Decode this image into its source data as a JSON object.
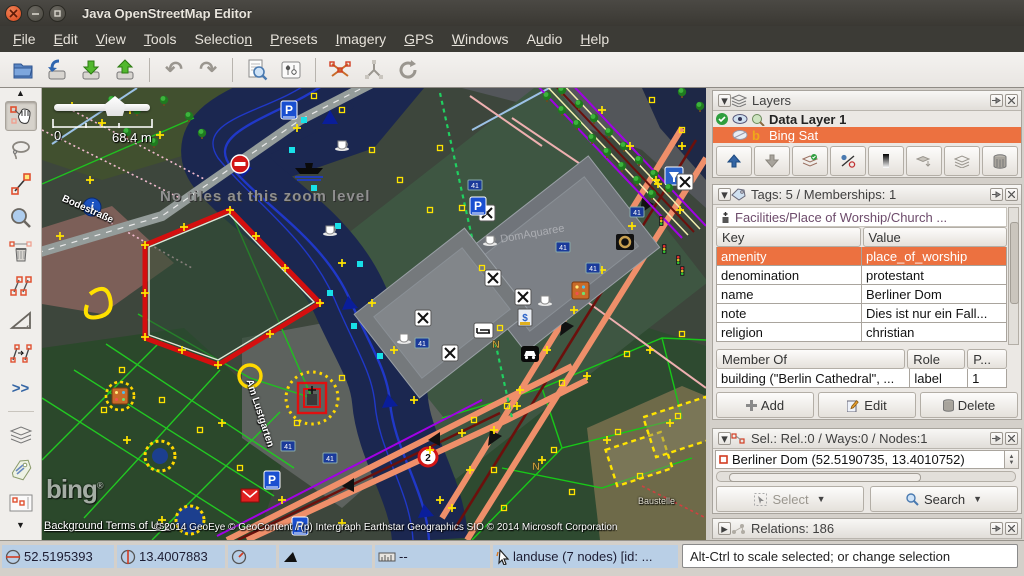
{
  "window": {
    "title": "Java OpenStreetMap Editor"
  },
  "menu": {
    "items": [
      {
        "pre": "",
        "mn": "F",
        "post": "ile"
      },
      {
        "pre": "",
        "mn": "E",
        "post": "dit"
      },
      {
        "pre": "",
        "mn": "V",
        "post": "iew"
      },
      {
        "pre": "",
        "mn": "T",
        "post": "ools"
      },
      {
        "pre": "Selectio",
        "mn": "n",
        "post": ""
      },
      {
        "pre": "",
        "mn": "P",
        "post": "resets"
      },
      {
        "pre": "",
        "mn": "I",
        "post": "magery"
      },
      {
        "pre": "",
        "mn": "G",
        "post": "PS"
      },
      {
        "pre": "",
        "mn": "W",
        "post": "indows"
      },
      {
        "pre": "A",
        "mn": "u",
        "post": "dio"
      },
      {
        "pre": "",
        "mn": "H",
        "post": "elp"
      }
    ]
  },
  "toolbar": {
    "buttons": [
      "open",
      "download-along",
      "download-data",
      "upload-data",
      "undo",
      "redo",
      "search",
      "preferences",
      "split-way",
      "combine-way",
      "refresh"
    ]
  },
  "tools_more": ">>",
  "map": {
    "no_tiles": "No tiles at this zoom level",
    "scale_min": "0",
    "scale_max": "68.4 m",
    "bing_logo": "bing",
    "bing_reg": "®",
    "terms_link": "Background Terms of Use",
    "copyright": "© 2014 GeoEye © GeoContent / (p) Intergraph Earthstar Geographics SIO © 2014 Microsoft Corporation",
    "street_bodestrasse": "Bodestraße",
    "street_am_lustgarten": "Am Lustgarten",
    "label_domaquaree": "DomAquaree",
    "label_baustelle": "Baustelle",
    "sign_parking": "P",
    "sign_housenumber": "41",
    "sign_speed": "2",
    "sign_info": "i",
    "sign_n": "N",
    "sign_bank": "$"
  },
  "layers": {
    "title": "Layers",
    "rows": [
      {
        "name": "Data Layer 1",
        "active": true
      },
      {
        "name": "Bing Sat",
        "selected": true
      }
    ]
  },
  "tags": {
    "title": "Tags: 5 / Memberships: 1",
    "preset": "Facilities/Place of Worship/Church ...",
    "columns": {
      "key": "Key",
      "value": "Value"
    },
    "rows": [
      {
        "key": "amenity",
        "value": "place_of_worship"
      },
      {
        "key": "denomination",
        "value": "protestant"
      },
      {
        "key": "name",
        "value": "Berliner Dom"
      },
      {
        "key": "note",
        "value": "Dies ist nur ein Fall..."
      },
      {
        "key": "religion",
        "value": "christian"
      }
    ],
    "membership": {
      "columns": {
        "member": "Member Of",
        "role": "Role",
        "pos": "P..."
      },
      "row": {
        "member": "building (\"Berlin Cathedral\", ...",
        "role": "label",
        "pos": "1"
      }
    },
    "buttons": {
      "add": "Add",
      "edit": "Edit",
      "delete": "Delete"
    }
  },
  "selection": {
    "title": "Sel.: Rel.:0 / Ways:0 / Nodes:1",
    "item": "Berliner Dom (52.5190735, 13.4010752)",
    "buttons": {
      "select": "Select",
      "search": "Search"
    }
  },
  "relations": {
    "title": "Relations: 186"
  },
  "status": {
    "lat": "52.5195393",
    "lon": "13.4007883",
    "heading": "",
    "angle": "",
    "dist": "--",
    "object": "landuse (7 nodes) [id: ...",
    "help": "Alt-Ctrl to scale selected; or change selection"
  }
}
